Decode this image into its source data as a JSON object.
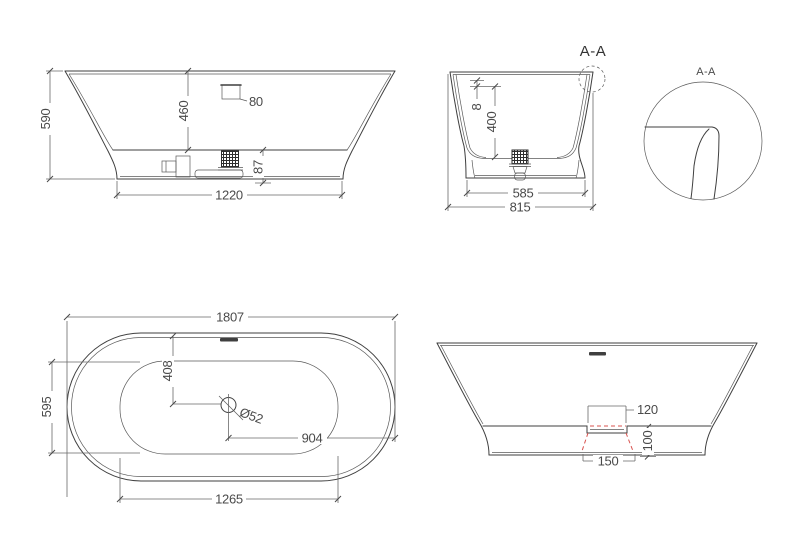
{
  "drawing": {
    "background_color": "#ffffff",
    "line_color": "#3f3f3f",
    "text_color": "#4a4a4a",
    "hidden_line_color": "#d9534f",
    "side_view": {
      "dims": {
        "overall_height": "590",
        "inner_depth": "460",
        "overflow_size": "80",
        "base_height": "87",
        "base_length": "1220"
      }
    },
    "end_section_view": {
      "section_label": "A-A",
      "dims": {
        "rim_lip": "8",
        "inner_depth": "400",
        "base_width": "585",
        "overall_width": "815"
      }
    },
    "detail_view": {
      "title": "A-A"
    },
    "plan_view": {
      "dims": {
        "overall_length": "1807",
        "inner_width": "595",
        "drain_offset_y": "408",
        "drain_diameter": "Ø52",
        "drain_offset_x": "904",
        "base_length": "1265"
      }
    },
    "cutout_view": {
      "dims": {
        "recess_top_width": "120",
        "recess_height": "100",
        "recess_bottom_width": "150"
      }
    }
  }
}
